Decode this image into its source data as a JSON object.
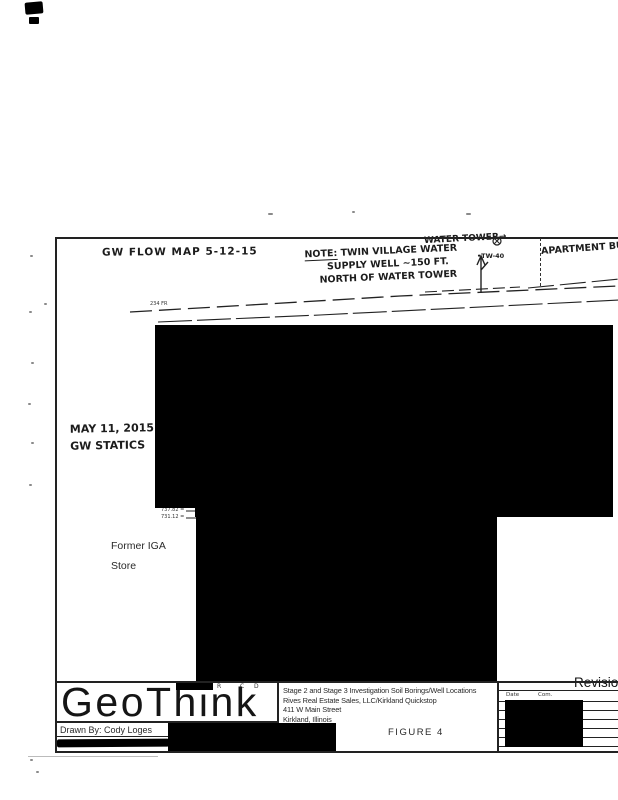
{
  "annotations": {
    "flow_map_title": "GW FLOW MAP 5-12-15",
    "note": {
      "prefix": "NOTE:",
      "line1": "TWIN VILLAGE WATER",
      "line2": "SUPPLY WELL ~150 FT.",
      "line3": "NORTH OF WATER TOWER"
    },
    "water_tower_label": "WATER TOWER→",
    "well_label": "•TW-40",
    "apartment_label": "APARTMENT BUI",
    "gw_date_line1": "MAY 11, 2015",
    "gw_date_line2": "GW STATICS",
    "road_label": "234 FR",
    "elev_label1": "737.82 =",
    "elev_label2": "731.12 =",
    "former_building_line1": "Former IGA",
    "former_building_line2": "Store",
    "legend_marks": [
      "R",
      "C",
      "D"
    ]
  },
  "title_block": {
    "company": "GeoThink",
    "drawn_by": "Drawn By:  Cody Loges",
    "project": {
      "line1": "Stage 2 and Stage 3 Investigation Soil Borings/Well Locations",
      "line2": "Rives Real Estate Sales, LLC/Kirkland Quickstop",
      "line3": "411 W Main Street",
      "line4": "Kirkland, Illinois",
      "line5": "IEMA # 891747"
    },
    "figure_label": "FIGURE 4",
    "revisions_label": "Revisions",
    "rev_header_date": "Date",
    "rev_header_comments": "Com."
  },
  "colors": {
    "ink": "#1a1a1a",
    "paper": "#ffffff",
    "redaction": "#000000"
  }
}
